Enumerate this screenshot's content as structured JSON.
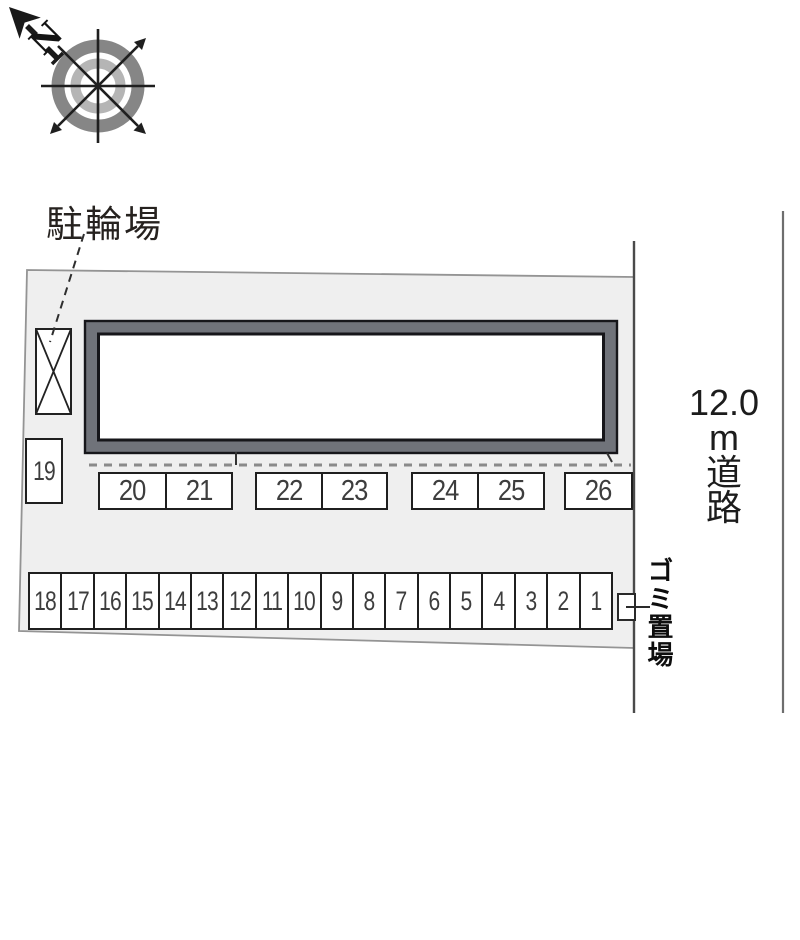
{
  "compass": {
    "north_label": "N"
  },
  "annotations": {
    "bicycle_label": "駐輪場",
    "road_label": {
      "number": "12.0",
      "unit": "m",
      "name_chars": [
        "道",
        "路"
      ]
    },
    "garbage_label": "ゴミ置場"
  },
  "parking": {
    "isolated_space": "19",
    "upper_groups": [
      [
        "20",
        "21"
      ],
      [
        "22",
        "23"
      ],
      [
        "24",
        "25"
      ],
      [
        "26"
      ]
    ],
    "lower_row": [
      "18",
      "17",
      "16",
      "15",
      "14",
      "13",
      "12",
      "11",
      "10",
      "9",
      "8",
      "7",
      "6",
      "5",
      "4",
      "3",
      "2",
      "1"
    ]
  },
  "colors": {
    "property_fill": "#efefef",
    "property_stroke": "#949494",
    "building_band": "#70737a",
    "line_dark": "#1a1a1a",
    "dash_gray": "#8a8a8a",
    "number_color": "#3d3d3d",
    "compass_outer_ring": "#868686",
    "compass_inner_ring": "#b5b5b5"
  }
}
